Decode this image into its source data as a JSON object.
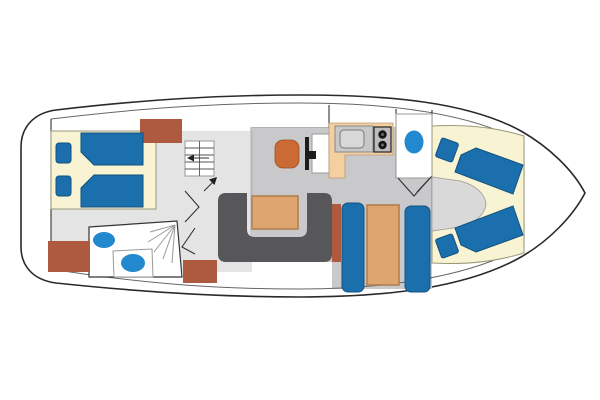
{
  "figure": {
    "kind": "yacht-deck-floorplan",
    "orientation": "bow-right",
    "regions": [
      "aft-cabin",
      "aft-head",
      "companionway-stairs",
      "salon",
      "helm",
      "galley",
      "forward-head",
      "dinette",
      "v-berth-cabin",
      "foredeck"
    ],
    "fixture_counts": {
      "beds_aft": 2,
      "beds_forward": 2,
      "pillows": 4,
      "stove_burners": 2,
      "sinks": 2,
      "toilets": 2
    }
  },
  "colors": {
    "outline": "#2a2a2a",
    "line": "#666666",
    "wall": "#333333",
    "deck": "#ffffff",
    "floor": "#e4e4e4",
    "floor_mid": "#c9c9cb",
    "cream": "#f7f3d3",
    "cream_line": "#99997a",
    "bed": "#1c6fad",
    "bed_line": "#11527f",
    "fixture": "#2289cf",
    "brown": "#ae5a41",
    "orange": "#cb6a34",
    "tan": "#dfa571",
    "tan_line": "#b08050",
    "sofa": "#57575a",
    "counter": "#f4d0a0",
    "appliance": "#c8c8c8",
    "burner": "#151515"
  }
}
